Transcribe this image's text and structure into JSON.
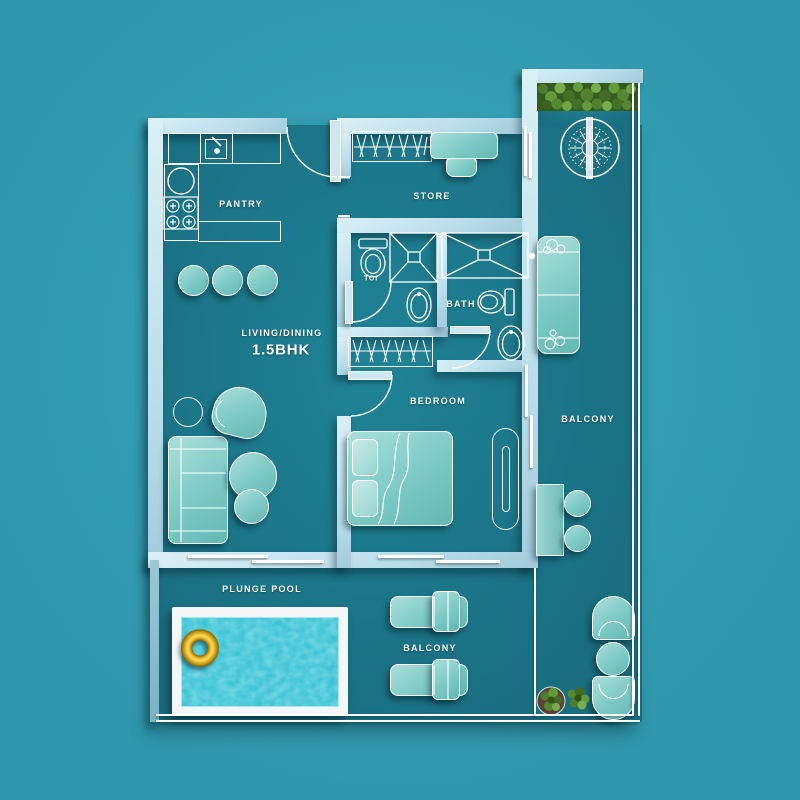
{
  "plan": {
    "type": "apartment floor plan, top view",
    "unit_type": "1.5BHK"
  },
  "labels": {
    "pantry": "PANTRY",
    "store": "STORE",
    "toi": "TOI",
    "bath": "BATH",
    "living_dining": "LIVING/DINING",
    "unit": "1.5BHK",
    "bedroom": "BEDROOM",
    "balcony_right": "BALCONY",
    "balcony_bottom": "BALCONY",
    "plunge_pool": "PLUNGE POOL"
  },
  "colors": {
    "bg-outer": "#2f97ab",
    "bg-outer-hi": "#3aa6ba",
    "bg-floor": "#196e80",
    "bg-floor-hi": "#1f8396",
    "wall": "#bcdfeb",
    "furniture": "#7cc9c4",
    "furniture-light": "#aadfda",
    "outline": "#ffffff",
    "pool-water": "#29bfd2",
    "swim-ring": "#e8b31e",
    "hedge-green": "#568733",
    "label-text": "#ffffff"
  },
  "furniture_icons": [
    "kitchen-sink-icon",
    "gas-hob-icon",
    "round-basin-icon",
    "bar-stool-icon",
    "wardrobe-hangers-icon",
    "study-desk-icon",
    "desk-chair-icon",
    "toilet-wc-icon",
    "shower-tray-icon",
    "washbasin-icon",
    "double-bed-icon",
    "pillow-icon",
    "bedside-bench-icon",
    "sofa-3-seat-icon",
    "armchair-icon",
    "coffee-table-icon",
    "side-table-icon",
    "balcony-sofa-icon",
    "wall-table-icon",
    "stool-icon",
    "sun-lounger-icon",
    "tub-chair-icon",
    "round-table-icon",
    "potted-plant-icon",
    "hedge-planter-icon",
    "decor-round-feature-icon",
    "swim-ring-icon",
    "plunge-pool-water",
    "door-swing-icon",
    "sliding-window-icon"
  ]
}
